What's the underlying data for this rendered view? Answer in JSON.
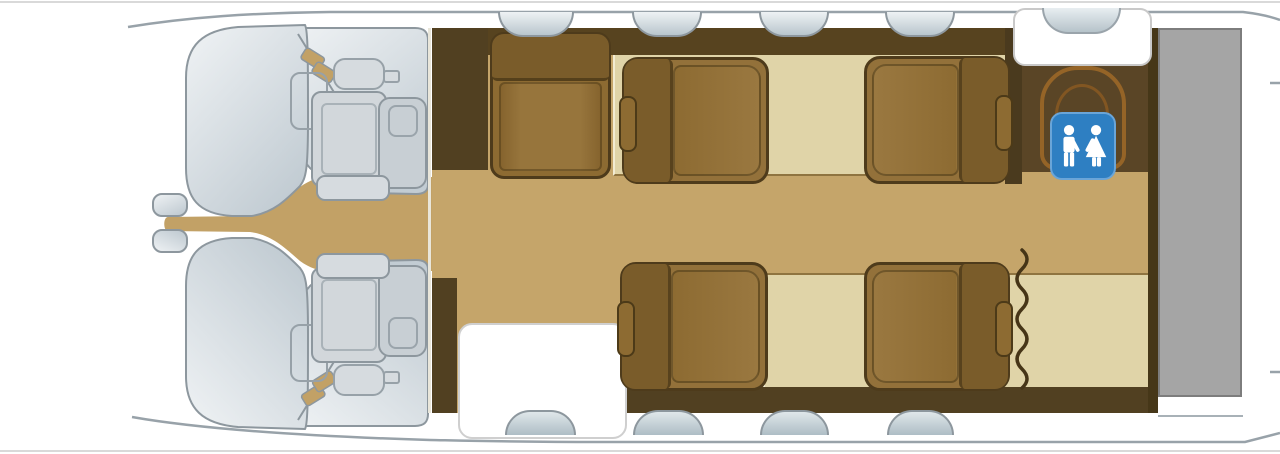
{
  "page": {
    "title": "Aircraft cabin floor plan",
    "diagram_type": "top-down seating layout",
    "orientation": "nose-left"
  },
  "zones": {
    "cockpit": {
      "label": "Cockpit",
      "crew_seats": 2
    },
    "cabin": {
      "label": "Main cabin",
      "passenger_seats": 5,
      "layout": "1 side-facing seat + 4 club seats facing each other"
    },
    "entry_door": {
      "label": "Entry door"
    },
    "lavatory": {
      "label": "Lavatory",
      "fixture": "toilet",
      "sign_icon": "restroom-man-woman-icon"
    },
    "vanity": {
      "label": "Sink / vanity unit"
    },
    "curtain": {
      "label": "Privacy curtain"
    },
    "baggage": {
      "label": "Baggage compartment"
    }
  },
  "seats": [
    {
      "id": "pilot-seat-top",
      "kind": "crew",
      "facing": "forward"
    },
    {
      "id": "pilot-seat-bottom",
      "kind": "crew",
      "facing": "forward"
    },
    {
      "id": "divan-seat",
      "kind": "passenger",
      "facing": "side-facing-aisle"
    },
    {
      "id": "club-seat-forward-top",
      "kind": "passenger",
      "facing": "aft"
    },
    {
      "id": "club-seat-aft-top",
      "kind": "passenger",
      "facing": "forward"
    },
    {
      "id": "club-seat-forward-bottom",
      "kind": "passenger",
      "facing": "aft"
    },
    {
      "id": "club-seat-aft-bottom",
      "kind": "passenger",
      "facing": "forward"
    }
  ],
  "windows": {
    "top_count": 4,
    "bottom_count": 3,
    "door_window": true,
    "vanity_basin": true
  },
  "colors": {
    "fuselage_outline": "#98a2a9",
    "nose_fill_light": "#eef1f3",
    "nose_fill_dark": "#c2ccd3",
    "floor_tan": "#c5a56a",
    "carpet_light": "#e0d4a8",
    "cabinetry_brown": "#57431f",
    "seat_brown": "#8d6b32",
    "seat_back_brown": "#7a5c2a",
    "crew_seat_gray": "#d2d7db",
    "lavatory_floor": "#5a4526",
    "toilet_outline": "#a06a28",
    "sign_blue": "#2e7fc2",
    "baggage_gray": "#a5a5a5"
  }
}
